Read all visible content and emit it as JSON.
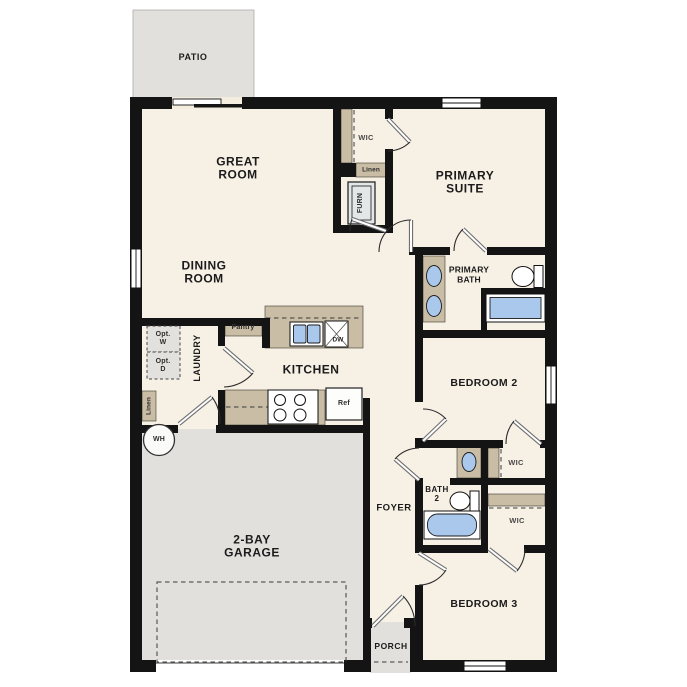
{
  "palette": {
    "wall": "#141414",
    "cream": "#f7f0e5",
    "ext": "#e1e0dd",
    "tan": "#c9bda5",
    "blue": "#a9c8ec"
  },
  "labels": {
    "patio": "PATIO",
    "great_room_1": "GREAT",
    "great_room_2": "ROOM",
    "dining_1": "DINING",
    "dining_2": "ROOM",
    "wic_primary": "WIC",
    "linen_primary": "Linen",
    "furn": "FURN",
    "primary_suite_1": "PRIMARY",
    "primary_suite_2": "SUITE",
    "primary_bath_1": "PRIMARY",
    "primary_bath_2": "BATH",
    "pantry": "Pantry",
    "laundry": "LAUNDRY",
    "opt_w_1": "Opt.",
    "opt_w_2": "W",
    "opt_d_1": "Opt.",
    "opt_d_2": "D",
    "linen_hall": "Linen",
    "wh": "WH",
    "kitchen": "KITCHEN",
    "dw": "DW",
    "ref": "Ref",
    "bedroom_2": "BEDROOM 2",
    "bath_2_1": "BATH",
    "bath_2_2": "2",
    "wic_a": "WIC",
    "wic_b": "WIC",
    "foyer": "FOYER",
    "garage_1": "2-BAY",
    "garage_2": "GARAGE",
    "bedroom_3": "BEDROOM 3",
    "porch": "PORCH"
  }
}
